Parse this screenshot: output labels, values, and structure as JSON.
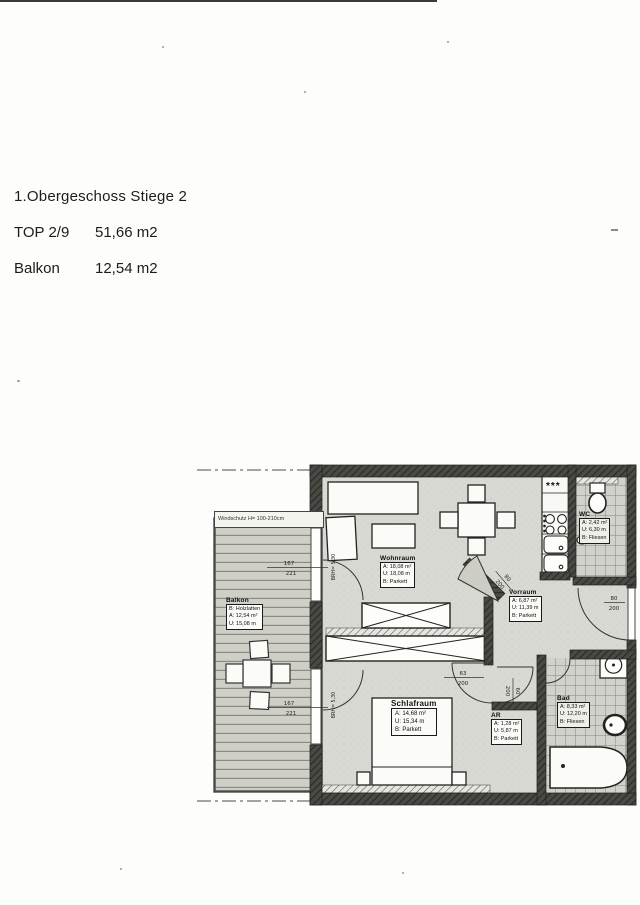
{
  "header": {
    "title": "1.Obergeschoss Stiege 2",
    "rows": [
      {
        "label": "TOP 2/9",
        "value": "51,66 m2"
      },
      {
        "label": "Balkon",
        "value": "12,54 m2"
      }
    ]
  },
  "plan": {
    "rooms": {
      "wohnraum": {
        "name": "Wohnraum",
        "a": "A: 18,08 m²",
        "u": "U: 18,08 m",
        "b": "B:  Parkett"
      },
      "schlafraum": {
        "name": "Schlafraum",
        "a": "A: 14,68 m²",
        "u": "U: 15,34 m",
        "b": "B:  Parkett"
      },
      "vorraum": {
        "name": "Vorraum",
        "a": "A: 6,87 m²",
        "u": "U: 11,39 m",
        "b": "B:  Parkett"
      },
      "ar": {
        "name": "AR",
        "a": "A: 1,28 m²",
        "u": "U: 5,87 m",
        "b": "B: Parkett"
      },
      "bad": {
        "name": "Bad",
        "a": "A: 8,33 m²",
        "u": "U: 12,20 m",
        "b": "B: Fliesen"
      },
      "wc": {
        "name": "WC",
        "a": "A: 2,42 m²",
        "u": "U: 6,30 m",
        "b": "B: Fliesen"
      },
      "balkon": {
        "name": "Balkon",
        "b": "B: Holzlatten",
        "a": "A: 12,54 m²",
        "u": "U: 15,08 m"
      }
    },
    "annotations": {
      "screen": "Windschutz H= 100-210cm",
      "stove": "***",
      "level_top": "BRH= 5,30",
      "level_bottom": "BRH= 5,30",
      "d_top_w": "167",
      "d_top_h": "221",
      "d_bot_w": "167",
      "d_bot_h": "221",
      "d_schlaf_w": "63",
      "d_schlaf_h": "200",
      "d_ar_w": "60",
      "d_ar_h": "200",
      "d_entry_w": "80",
      "d_entry_h": "200",
      "d_diag_w": "80",
      "d_diag_h": "200"
    }
  }
}
